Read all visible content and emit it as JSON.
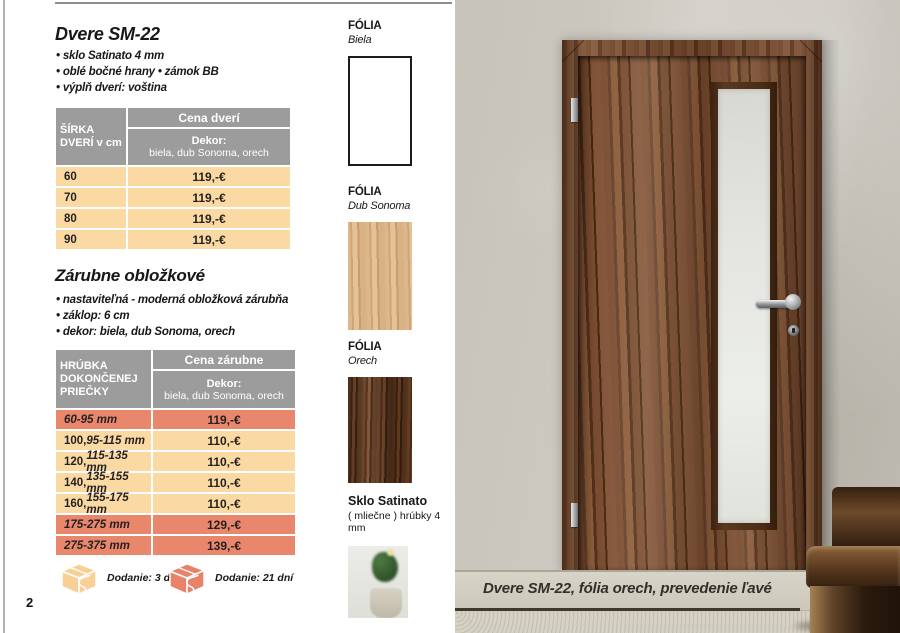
{
  "page_number": "2",
  "product": {
    "title": "Dvere SM-22",
    "bullets": [
      "• sklo Satinato 4 mm",
      "• oblé bočné hrany   • zámok BB",
      "• výplň dverí: voština"
    ]
  },
  "doors_table": {
    "col_header": "ŠÍRKA DVERÍ v cm",
    "price_header": "Cena dverí",
    "dekor_label": "Dekor:",
    "dekor_values": "biela, dub Sonoma, orech",
    "rows": [
      {
        "width": "60",
        "price": "119,-€"
      },
      {
        "width": "70",
        "price": "119,-€"
      },
      {
        "width": "80",
        "price": "119,-€"
      },
      {
        "width": "90",
        "price": "119,-€"
      }
    ]
  },
  "frames_section": {
    "title": "Zárubne obložkové",
    "bullets": [
      "• nastaviteľná - moderná obložková zárubňa",
      "• záklop: 6 cm",
      "• dekor: biela, dub Sonoma, orech"
    ]
  },
  "frames_table": {
    "col_header": "HRÚBKA DOKONČENEJ PRIEČKY",
    "price_header": "Cena zárubne",
    "dekor_label": "Dekor:",
    "dekor_values": "biela, dub Sonoma, orech",
    "rows": [
      {
        "bold": "",
        "italic": "60-95 mm",
        "price": "119,-€",
        "variant": "salmon"
      },
      {
        "bold": "100,",
        "italic": " 95-115 mm",
        "price": "110,-€",
        "variant": "peach"
      },
      {
        "bold": "120,",
        "italic": " 115-135 mm",
        "price": "110,-€",
        "variant": "peach"
      },
      {
        "bold": "140,",
        "italic": " 135-155 mm",
        "price": "110,-€",
        "variant": "peach"
      },
      {
        "bold": "160,",
        "italic": " 155-175 mm",
        "price": "110,-€",
        "variant": "peach"
      },
      {
        "bold": "",
        "italic": "175-275 mm",
        "price": "129,-€",
        "variant": "salmon"
      },
      {
        "bold": "",
        "italic": "275-375 mm",
        "price": "139,-€",
        "variant": "salmon"
      }
    ]
  },
  "delivery": [
    {
      "label": "Dodanie: 3 dni",
      "variant": "peach"
    },
    {
      "label": "Dodanie: 21 dní",
      "variant": "salmon"
    }
  ],
  "swatches": [
    {
      "heading": "FÓLIA",
      "name": "Biela",
      "texture": "white"
    },
    {
      "heading": "FÓLIA",
      "name": "Dub Sonoma",
      "texture": "oak"
    },
    {
      "heading": "FÓLIA",
      "name": "Orech",
      "texture": "walnut"
    }
  ],
  "glass_sample": {
    "heading": "Sklo Satinato",
    "subtitle": "( mliečne ) hrúbky 4 mm"
  },
  "photo": {
    "caption": "Dvere SM-22, fólia orech, prevedenie ľavé"
  },
  "colors": {
    "row_peach": "#fbd9a2",
    "row_salmon": "#e9876d",
    "header_gray": "#9c9c9c",
    "icon_peach": "#f8cf95",
    "icon_salmon": "#e8836a"
  }
}
